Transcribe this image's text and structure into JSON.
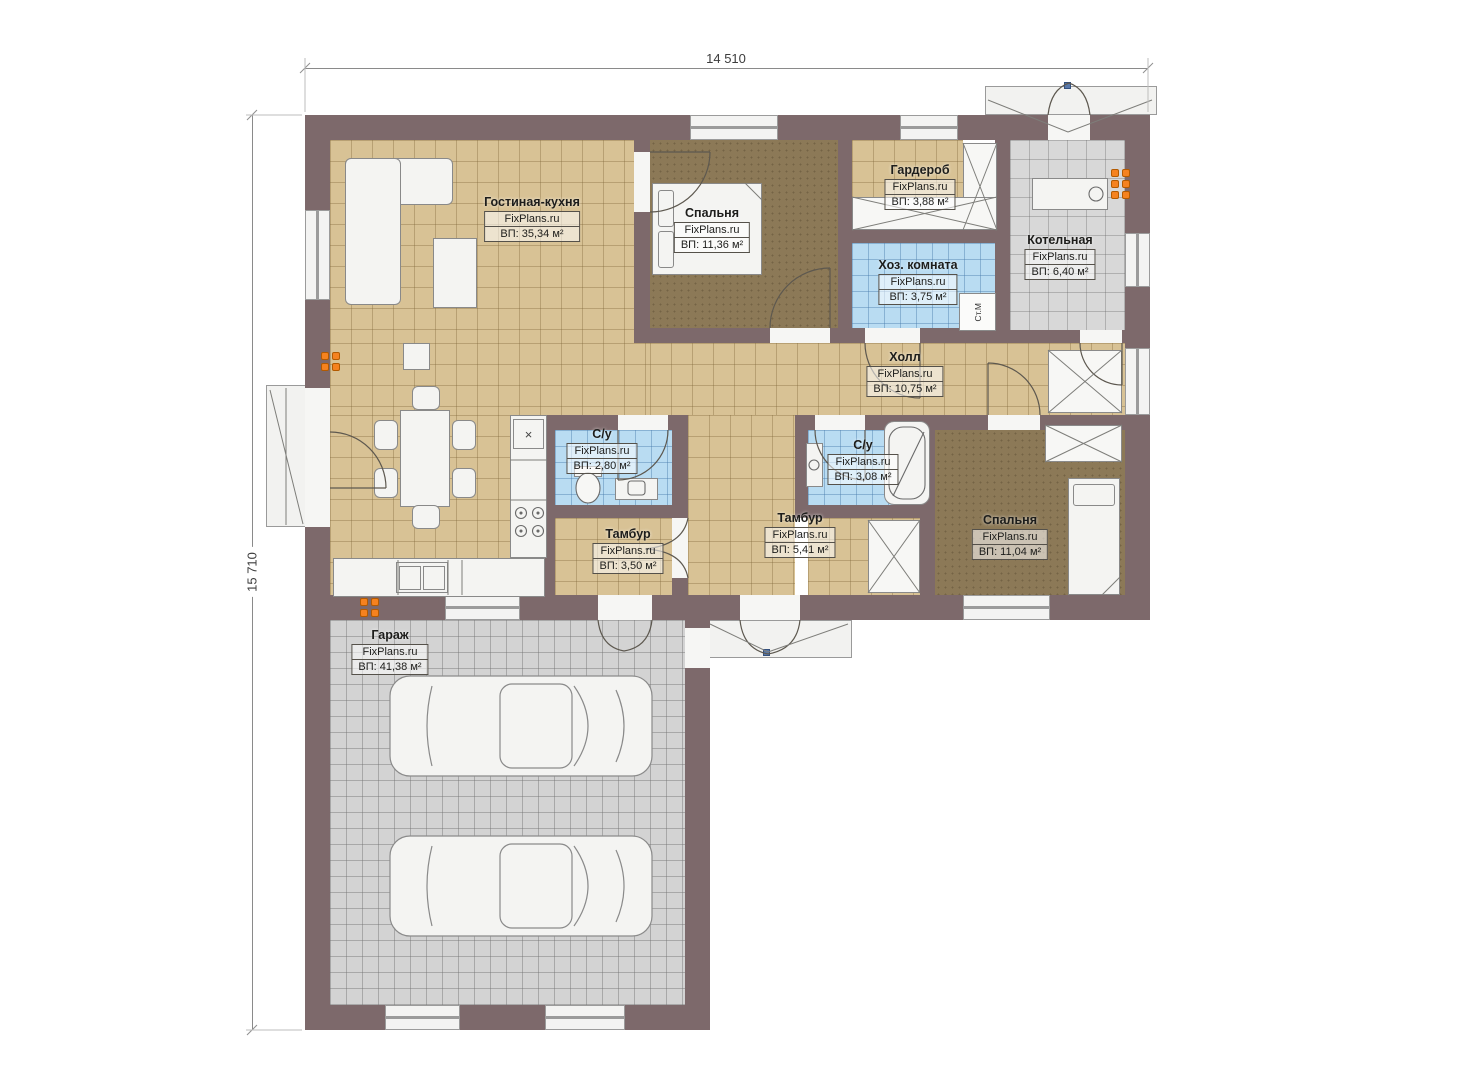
{
  "dimensions": {
    "top": "14 510",
    "left": "15 710"
  },
  "rooms": [
    {
      "name": "Гостиная-кухня",
      "brand": "FixPlans.ru",
      "area": "ВП: 35,34 м²"
    },
    {
      "name": "Спальня",
      "brand": "FixPlans.ru",
      "area": "ВП: 11,36 м²"
    },
    {
      "name": "Гардероб",
      "brand": "FixPlans.ru",
      "area": "ВП: 3,88 м²"
    },
    {
      "name": "Хоз. комната",
      "brand": "FixPlans.ru",
      "area": "ВП: 3,75 м²"
    },
    {
      "name": "Котельная",
      "brand": "FixPlans.ru",
      "area": "ВП: 6,40 м²"
    },
    {
      "name": "Холл",
      "brand": "FixPlans.ru",
      "area": "ВП: 10,75 м²"
    },
    {
      "name": "С/у",
      "brand": "FixPlans.ru",
      "area": "ВП: 2,80 м²"
    },
    {
      "name": "С/у",
      "brand": "FixPlans.ru",
      "area": "ВП: 3,08 м²"
    },
    {
      "name": "Тамбур",
      "brand": "FixPlans.ru",
      "area": "ВП: 3,50 м²"
    },
    {
      "name": "Тамбур",
      "brand": "FixPlans.ru",
      "area": "ВП: 5,41 м²"
    },
    {
      "name": "Спальня",
      "brand": "FixPlans.ru",
      "area": "ВП: 11,04 м²"
    },
    {
      "name": "Гараж",
      "brand": "FixPlans.ru",
      "area": "ВП: 41,38 м²"
    }
  ],
  "annotations": {
    "washing_machine": "Ст.М",
    "hob_symbol": "×"
  },
  "colors": {
    "wall": "#7d696b",
    "floor_tan": "#d8c295",
    "floor_carpet": "#8c7957",
    "floor_blue": "#b9dcf2",
    "floor_gray": "#d8d8d8",
    "radiator": "#f5821f"
  }
}
